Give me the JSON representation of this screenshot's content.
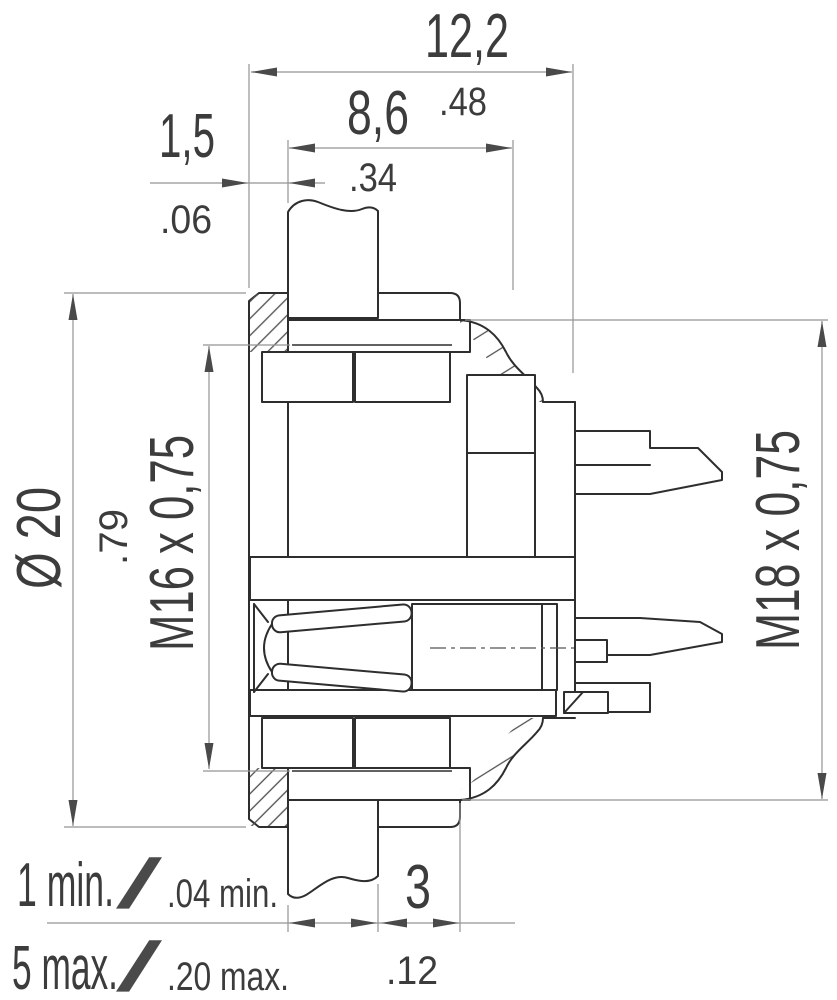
{
  "dims": {
    "overall": {
      "mm": "12,2",
      "inch": ".48"
    },
    "front": {
      "mm": "8,6",
      "inch": ".34"
    },
    "flange": {
      "mm": "1,5",
      "inch": ".06"
    },
    "diameter": {
      "mm": "Ø 20",
      "inch": ".79"
    },
    "thread_front": "M16 x 0,75",
    "thread_rear": "M18 x 0,75",
    "rear_gap": {
      "mm": "3",
      "inch": ".12"
    },
    "panel_min": {
      "mm": "1 min.",
      "inch": ".04 min."
    },
    "panel_max": {
      "mm": "5 max.",
      "inch": ".20 max."
    },
    "slash": "/"
  },
  "colors": {
    "outline": "#2e2e2e",
    "dimension_lines": "#949494",
    "text": "#3c3c3c",
    "hatch": "#4d4d4d",
    "background": "#ffffff"
  }
}
